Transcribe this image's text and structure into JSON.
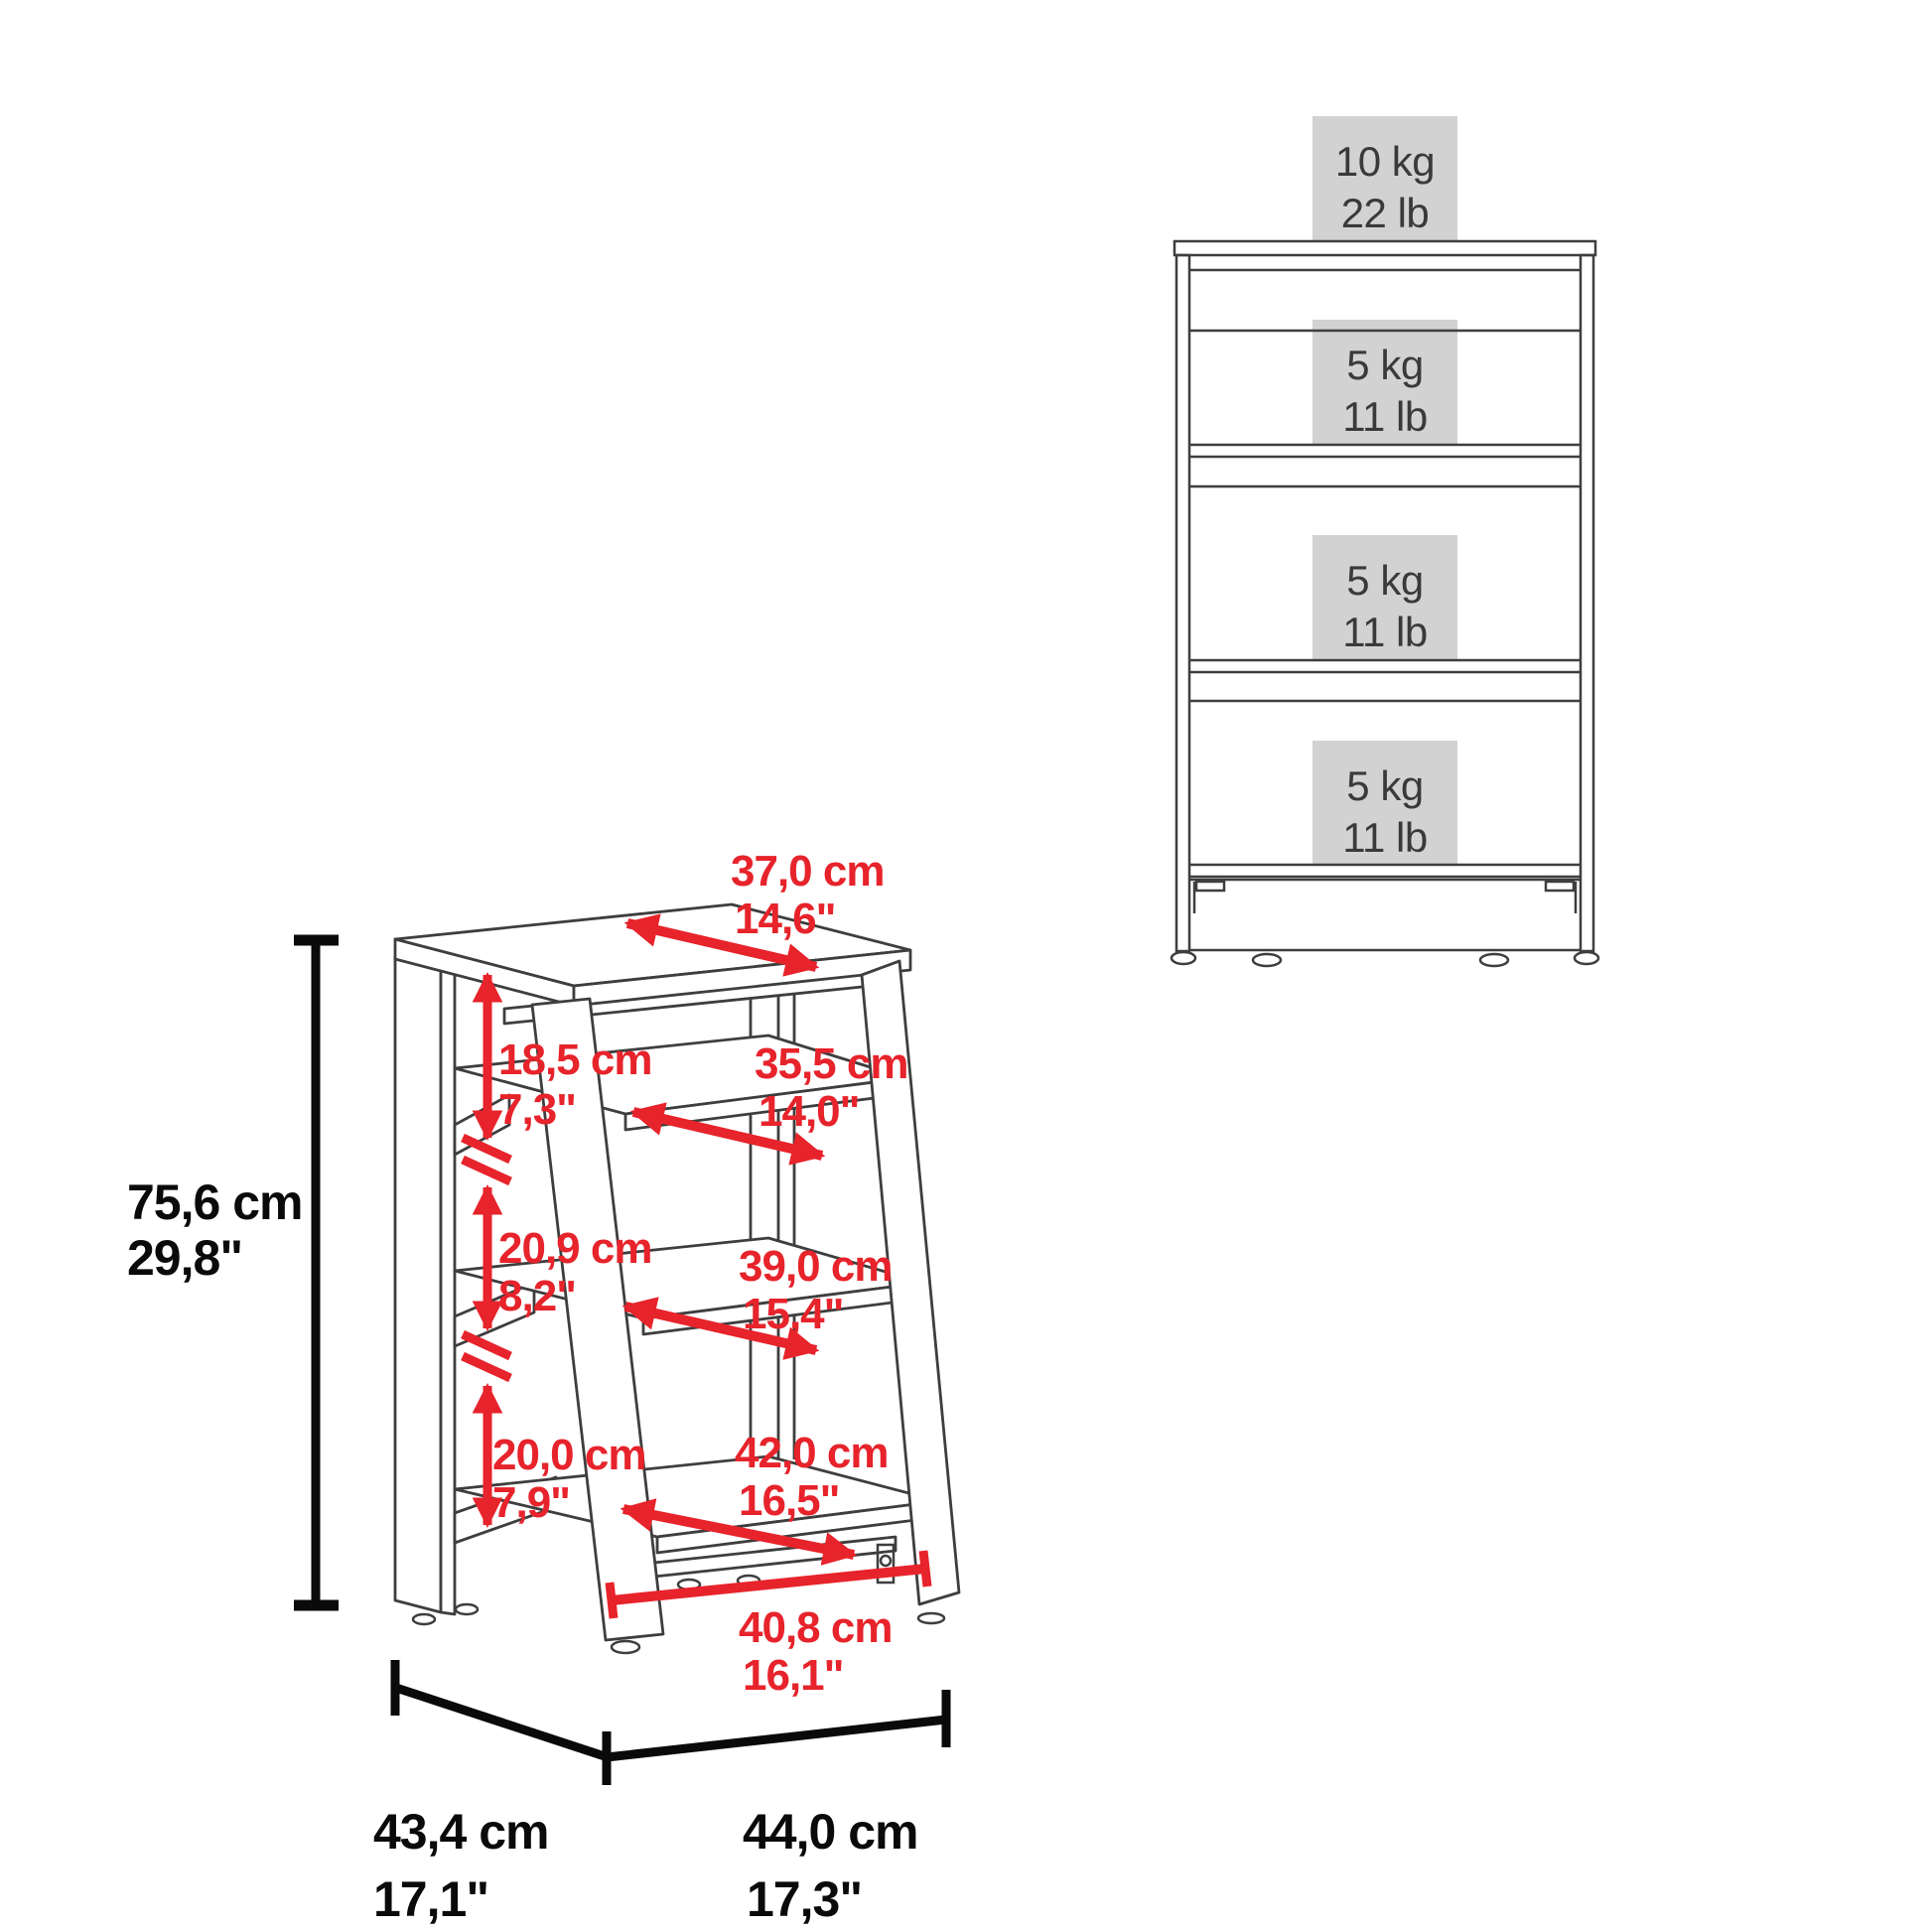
{
  "diagram": {
    "left_view": {
      "overall_height": {
        "cm": "75,6 cm",
        "inches": "29,8\""
      },
      "top_depth": {
        "cm": "37,0 cm",
        "inches": "14,6\""
      },
      "gap_top_shelf": {
        "cm": "18,5 cm",
        "inches": "7,3\""
      },
      "shelf1_depth": {
        "cm": "35,5 cm",
        "inches": "14,0\""
      },
      "gap_middle_shelf": {
        "cm": "20,9 cm",
        "inches": "8,2\""
      },
      "shelf2_depth": {
        "cm": "39,0 cm",
        "inches": "15,4\""
      },
      "gap_bottom_shelf": {
        "cm": "20,0 cm",
        "inches": "7,9\""
      },
      "shelf3_depth": {
        "cm": "42,0 cm",
        "inches": "16,5\""
      },
      "base_inner_width": {
        "cm": "40,8 cm",
        "inches": "16,1\""
      },
      "base_depth": {
        "cm": "43,4 cm",
        "inches": "17,1\""
      },
      "base_width": {
        "cm": "44,0 cm",
        "inches": "17,3\""
      }
    },
    "right_view": {
      "load_capacities": [
        {
          "kg": "10 kg",
          "lb": "22 lb"
        },
        {
          "kg": "5 kg",
          "lb": "11 lb"
        },
        {
          "kg": "5 kg",
          "lb": "11 lb"
        },
        {
          "kg": "5 kg",
          "lb": "11 lb"
        }
      ]
    },
    "colors": {
      "dimension_red": "#e7232b",
      "line_dark": "#3e3e3e",
      "capacity_box_gray": "#d2d2d2",
      "capacity_text": "#3a3a3a",
      "dim_black": "#0a0a0a",
      "background": "#ffffff"
    }
  }
}
